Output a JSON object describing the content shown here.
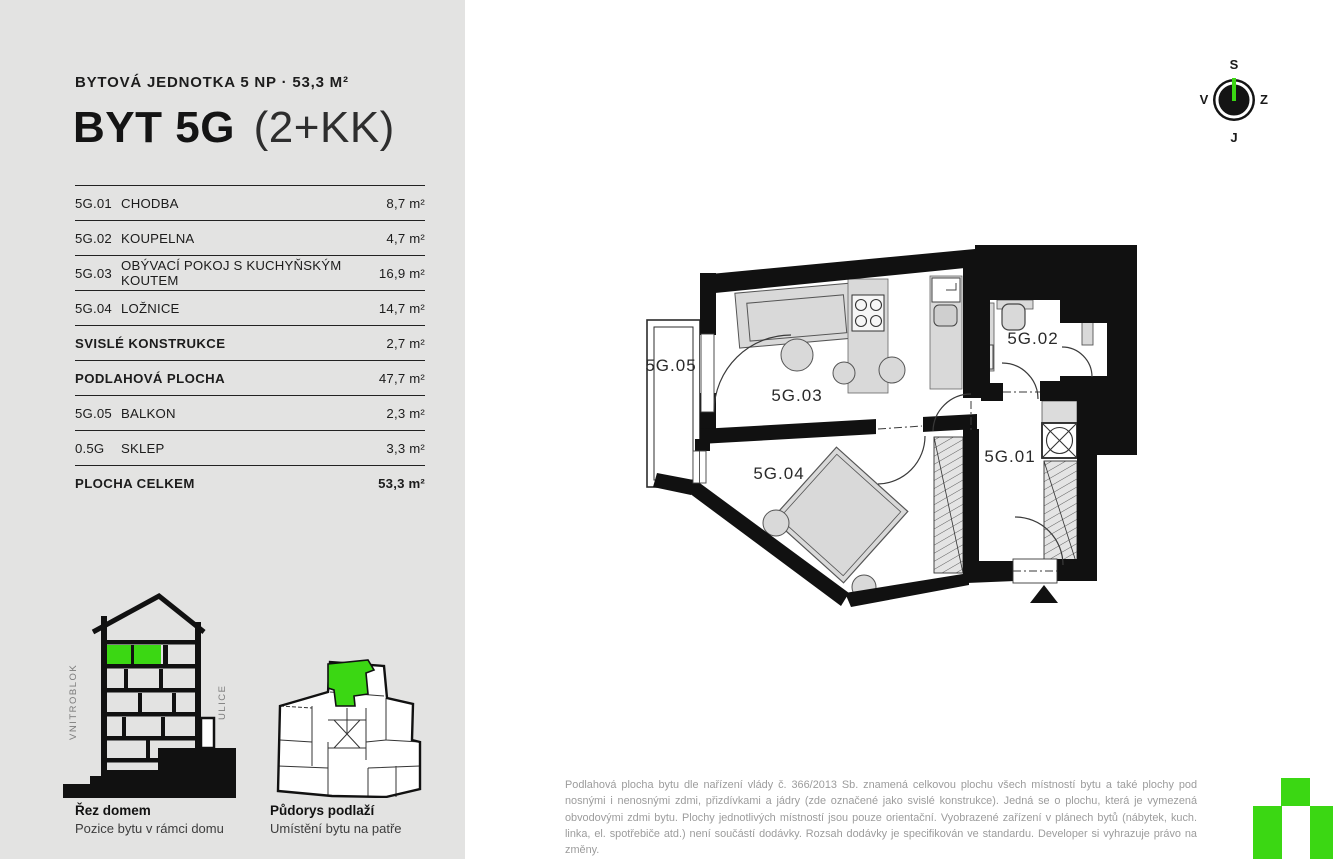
{
  "header": {
    "subtitle": "BYTOVÁ JEDNOTKA 5 NP · 53,3 M²",
    "title_bold": "BYT 5G",
    "title_light": "(2+KK)"
  },
  "table": {
    "rows": [
      {
        "code": "5G.01",
        "name": "CHODBA",
        "area": "8,7 m²",
        "bold": false,
        "bold_val": false
      },
      {
        "code": "5G.02",
        "name": "KOUPELNA",
        "area": "4,7 m²",
        "bold": false,
        "bold_val": false
      },
      {
        "code": "5G.03",
        "name": "OBÝVACÍ POKOJ S KUCHYŇSKÝM KOUTEM",
        "area": "16,9 m²",
        "bold": false,
        "bold_val": false
      },
      {
        "code": "5G.04",
        "name": "LOŽNICE",
        "area": "14,7 m²",
        "bold": false,
        "bold_val": false
      },
      {
        "code": "",
        "name": "SVISLÉ KONSTRUKCE",
        "area": "2,7 m²",
        "bold": true,
        "bold_val": false
      },
      {
        "code": "",
        "name": "PODLAHOVÁ PLOCHA",
        "area": "47,7 m²",
        "bold": true,
        "bold_val": false
      },
      {
        "code": "5G.05",
        "name": "BALKON",
        "area": "2,3 m²",
        "bold": false,
        "bold_val": false
      },
      {
        "code": "0.5G",
        "name": "SKLEP",
        "area": "3,3 m²",
        "bold": false,
        "bold_val": false
      },
      {
        "code": "",
        "name": "PLOCHA CELKEM",
        "area": "53,3 m²",
        "bold": true,
        "bold_val": true
      }
    ]
  },
  "plan": {
    "labels": {
      "hallway": "5G.01",
      "bathroom": "5G.02",
      "living": "5G.03",
      "bedroom": "5G.04",
      "balcony": "5G.05"
    }
  },
  "compass": {
    "north": "S",
    "west": "V",
    "east": "Z",
    "south": "J"
  },
  "diagrams": {
    "section": {
      "title": "Řez domem",
      "subtitle": "Pozice bytu v rámci domu",
      "label_left": "VNITROBLOK",
      "label_right": "ULICE"
    },
    "floor": {
      "title": "Půdorys podlaží",
      "subtitle": "Umístění bytu na patře"
    }
  },
  "disclaimer": "Podlahová plocha bytu dle nařízení vlády č. 366/2013 Sb. znamená celkovou plochu všech místností bytu a také plochy pod nosnými i nenosnými zdmi, přizdívkami a jádry (zde označené jako svislé konstrukce). Jedná se o plochu, která je vymezená obvodovými zdmi bytu. Plochy jednotlivých místností jsou pouze orientační. Vyobrazené zařízení v plánech bytů (nábytek, kuch. linka, el. spotřebiče atd.) není součástí dodávky. Rozsah dodávky je specifikován ve standardu. Developer si vyhrazuje právo na změny.",
  "colors": {
    "accent_green": "#3bd713",
    "sidebar_bg": "#e3e3e2",
    "wall_black": "#111111"
  }
}
